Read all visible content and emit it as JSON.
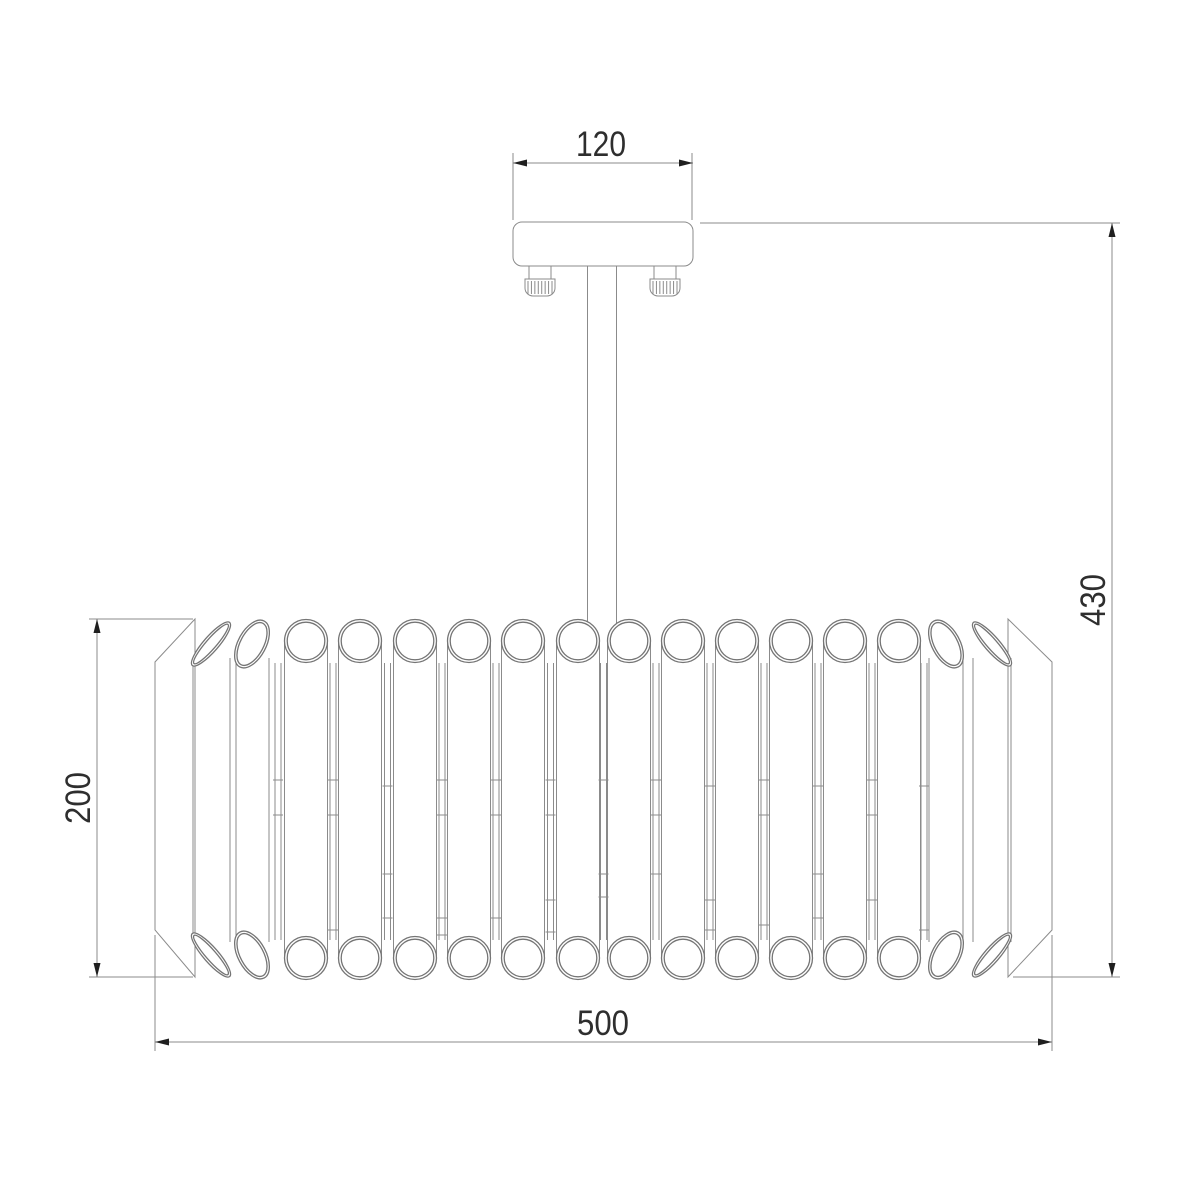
{
  "drawing": {
    "type": "technical-dimension-drawing",
    "subject": "ceiling chandelier with crystal tube drum shade, front elevation",
    "background": "#ffffff",
    "line_color": "#8b8b8b",
    "accent_color": "#1f1f1f",
    "text_color": "#2e2e2e"
  },
  "dimensions": {
    "plate_width": "120",
    "overall_height": "430",
    "shade_height": "200",
    "shade_diameter": "500"
  },
  "lamp_body": {
    "tube_count": 16,
    "circle_tubes_cx": [
      306,
      360,
      415,
      469,
      523,
      578,
      629,
      683,
      737,
      791,
      845,
      899
    ],
    "circle_top_cy": 641,
    "circle_bot_cy": 958,
    "r_outer": 21.5,
    "r_inner": 18.8,
    "tilted_tubes": [
      {
        "cx": 211,
        "cy_top": 644,
        "cy_bot": 955,
        "rx": 7.5,
        "ry": 28.5,
        "rot": 41,
        "lines": [
          193,
          230
        ]
      },
      {
        "cx": 992,
        "cy_top": 644,
        "cy_bot": 955,
        "rx": 7.5,
        "ry": 28.5,
        "rot": -41,
        "lines": [
          973,
          1011
        ]
      },
      {
        "cx": 252,
        "cy_top": 644,
        "cy_bot": 955,
        "rx": 14,
        "ry": 26,
        "rot": 28,
        "lines": [
          236,
          269
        ]
      },
      {
        "cx": 946,
        "cy_top": 644,
        "cy_bot": 955,
        "rx": 14,
        "ry": 26,
        "rot": -28,
        "lines": [
          929,
          963
        ]
      }
    ],
    "gap_strips": [
      {
        "cx": 278,
        "ticks": [
          780,
          815
        ]
      },
      {
        "cx": 333,
        "ticks": [
          780,
          815,
          930
        ]
      },
      {
        "cx": 387.5,
        "ticks": [
          786,
          874,
          918
        ]
      },
      {
        "cx": 442,
        "ticks": [
          780,
          815,
          918,
          935
        ]
      },
      {
        "cx": 496,
        "ticks": [
          780,
          815,
          918
        ]
      },
      {
        "cx": 550.5,
        "ticks": [
          780,
          815,
          900,
          932
        ]
      },
      {
        "cx": 603.5,
        "ticks": [
          780,
          874,
          897
        ]
      },
      {
        "cx": 656,
        "ticks": [
          780,
          815,
          874
        ]
      },
      {
        "cx": 710,
        "ticks": [
          786,
          900,
          930
        ]
      },
      {
        "cx": 764,
        "ticks": [
          780,
          815,
          925
        ]
      },
      {
        "cx": 818,
        "ticks": [
          786,
          874,
          918
        ]
      },
      {
        "cx": 872,
        "ticks": [
          780,
          815,
          900
        ]
      },
      {
        "cx": 924,
        "ticks": [
          786,
          930
        ]
      }
    ],
    "strip_top": 663,
    "strip_bot": 940,
    "strip_half": 3,
    "tick_half": 5,
    "tube_line_top": 641,
    "tube_line_bot": 958,
    "tilted_line_top": 658,
    "tilted_line_bot": 942
  },
  "screws": {
    "cx": [
      540,
      665
    ],
    "knurl_count": 8
  }
}
